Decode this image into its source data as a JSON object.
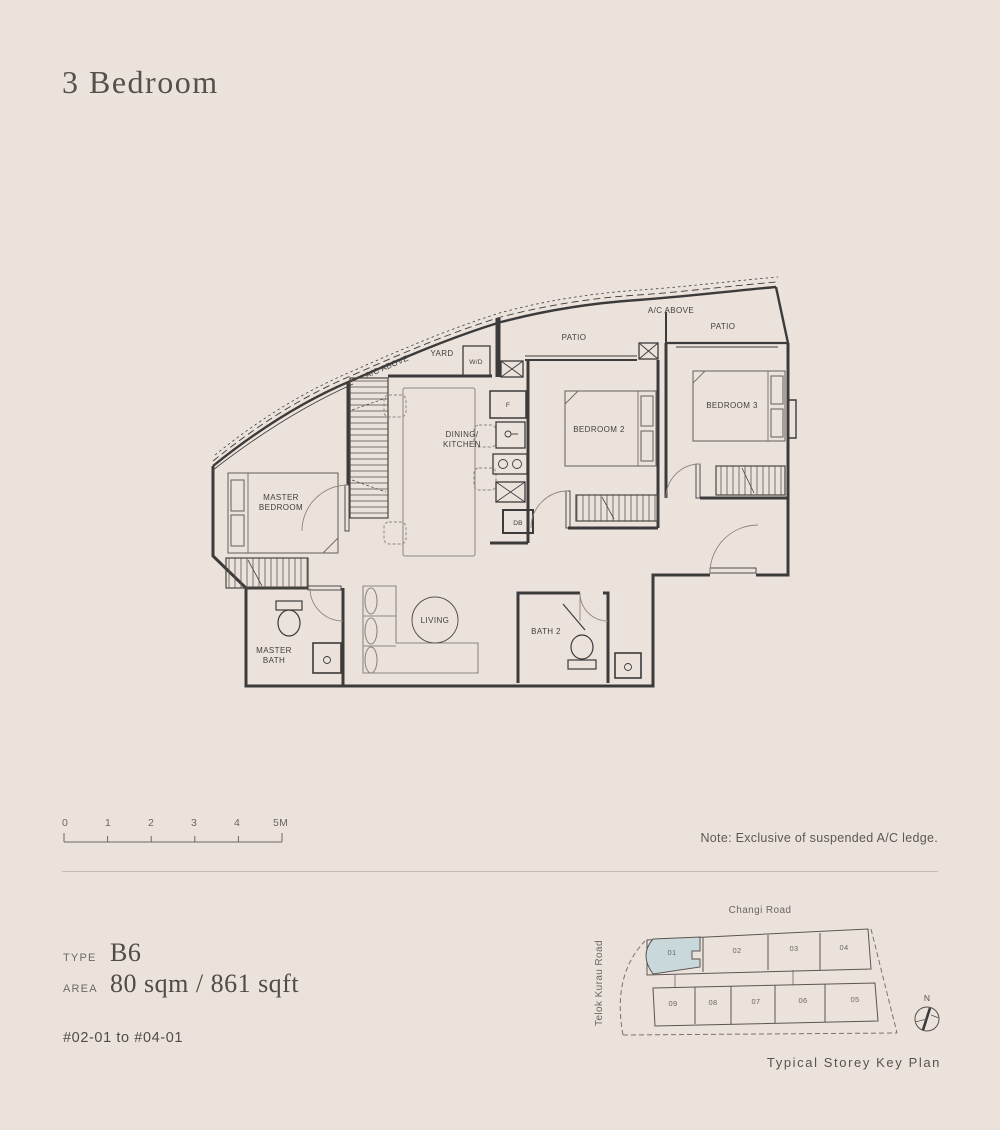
{
  "page": {
    "title": "3 Bedroom",
    "note": "Note: Exclusive of suspended A/C ledge.",
    "unit_range": "#02-01 to #04-01"
  },
  "spec": {
    "type_label": "TYPE",
    "type_value": "B6",
    "area_label": "AREA",
    "area_value": "80 sqm / 861 sqft"
  },
  "scale_bar": {
    "ticks": [
      "0",
      "1",
      "2",
      "3",
      "4",
      "5M"
    ]
  },
  "floor_plan": {
    "labels": {
      "master_bedroom_1": "MASTER",
      "master_bedroom_2": "BEDROOM",
      "dining_1": "DINING/",
      "dining_2": "KITCHEN",
      "yard": "YARD",
      "wd": "W/D",
      "fridge": "F",
      "db": "DB",
      "ac_above_left": "A/C ABOVE",
      "ac_above_right": "A/C ABOVE",
      "patio_left": "PATIO",
      "patio_right": "PATIO",
      "bedroom2": "BEDROOM 2",
      "bedroom3": "BEDROOM 3",
      "living": "LIVING",
      "bath2": "BATH 2",
      "master_bath_1": "MASTER",
      "master_bath_2": "BATH"
    }
  },
  "key_plan": {
    "road_top": "Changi Road",
    "road_left": "Telok Kurau Road",
    "caption": "Typical Storey Key Plan",
    "compass": "N",
    "highlighted_unit": "01",
    "highlight_color": "#c9d8da",
    "units_top": [
      "01",
      "02",
      "03",
      "04"
    ],
    "units_bottom": [
      "09",
      "08",
      "07",
      "06",
      "05"
    ]
  },
  "colors": {
    "background": "#ece2dc",
    "wall": "#3b3b3b",
    "furniture": "#8d8781",
    "accent": "#c9d8da"
  }
}
